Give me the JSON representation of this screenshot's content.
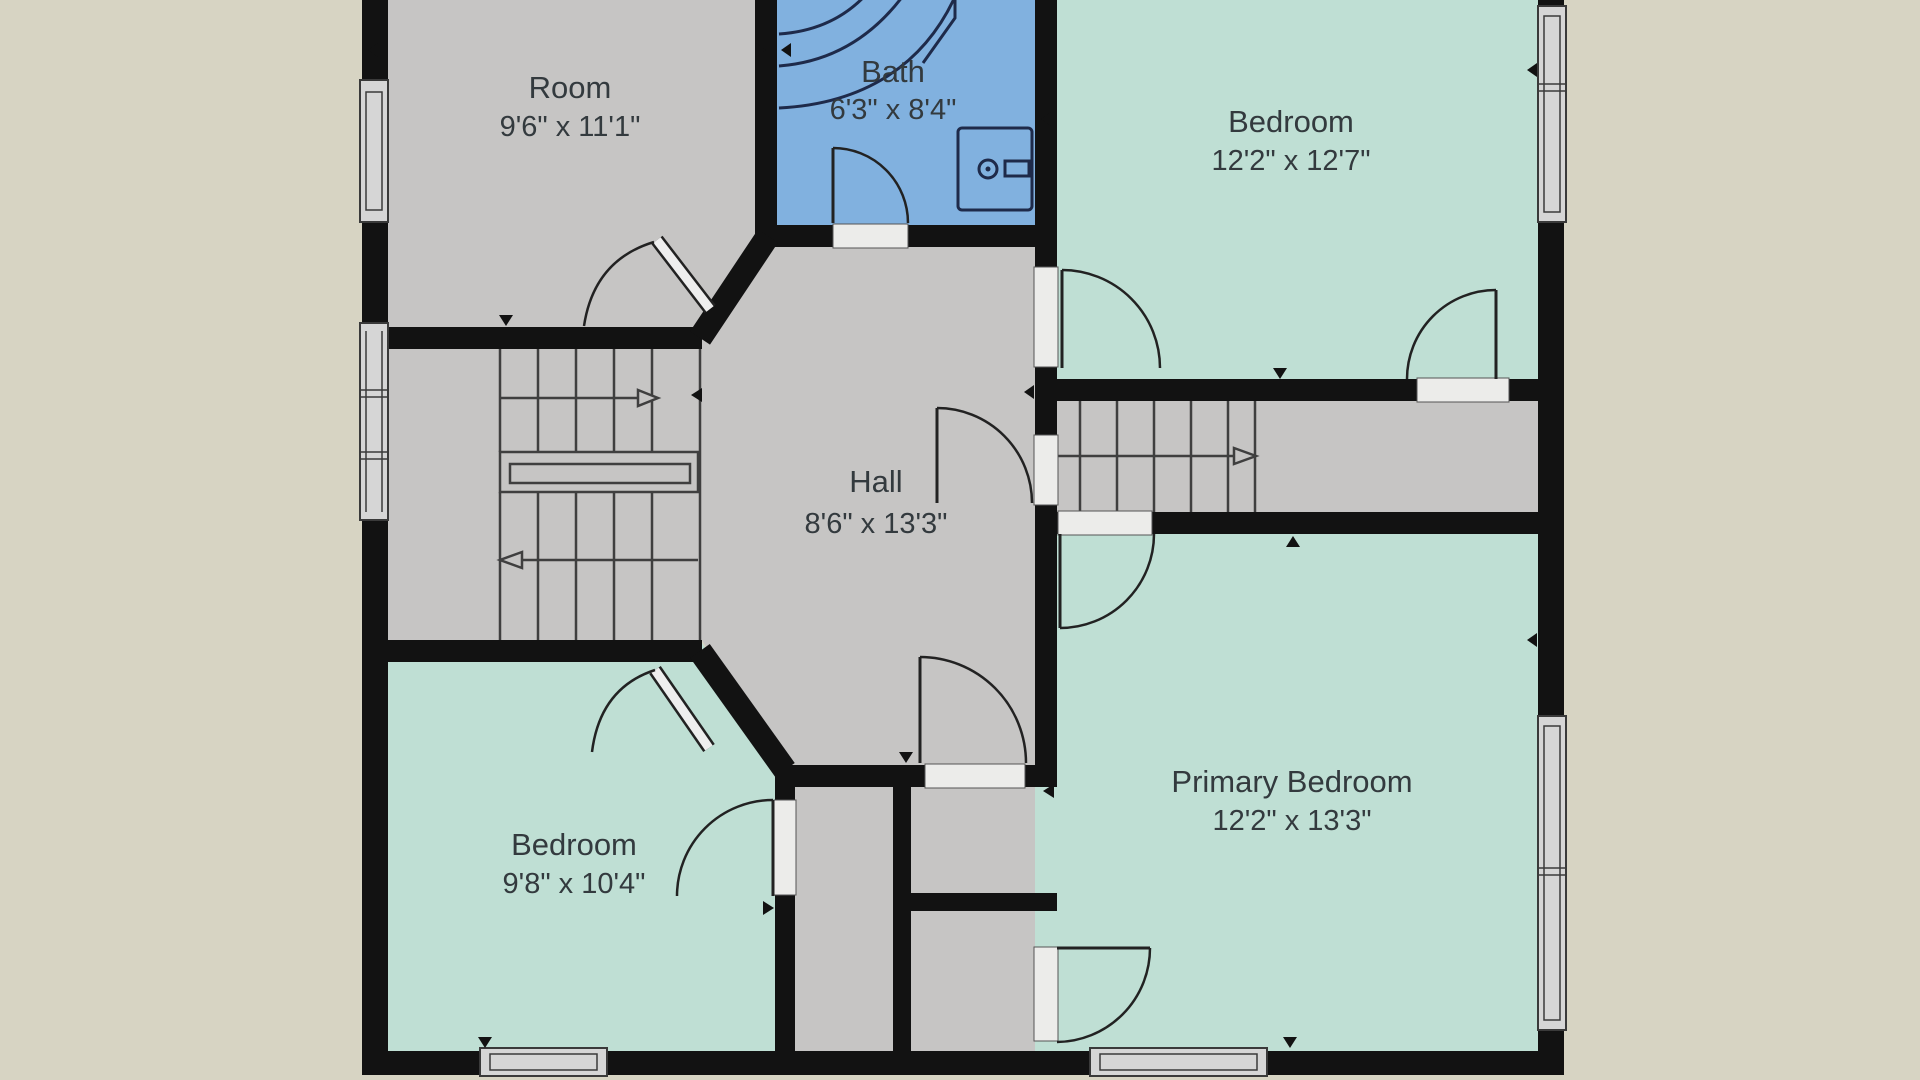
{
  "title": "Floor plan",
  "background_color": "#d7d4c3",
  "palette": {
    "wall": "#121212",
    "room_gray": "#c6c5c4",
    "bedroom_mint": "#bfdfd4",
    "bath_blue": "#81b1df",
    "label": "#333a3e"
  },
  "rooms": {
    "room": {
      "name": "Room",
      "dims": "9'6\" x 11'1\""
    },
    "bath": {
      "name": "Bath",
      "dims": "6'3\" x 8'4\""
    },
    "bedroom_top_right": {
      "name": "Bedroom",
      "dims": "12'2\" x 12'7\""
    },
    "hall": {
      "name": "Hall",
      "dims": "8'6\" x 13'3\""
    },
    "bedroom_bottom_left": {
      "name": "Bedroom",
      "dims": "9'8\" x 10'4\""
    },
    "primary_bedroom": {
      "name": "Primary Bedroom",
      "dims": "12'2\" x 13'3\""
    }
  },
  "features": {
    "stairs_left": "switchback staircase with up/down arrows",
    "stairs_right": "straight stair corridor with arrow",
    "bath_fixtures": "bathtub and washer"
  }
}
